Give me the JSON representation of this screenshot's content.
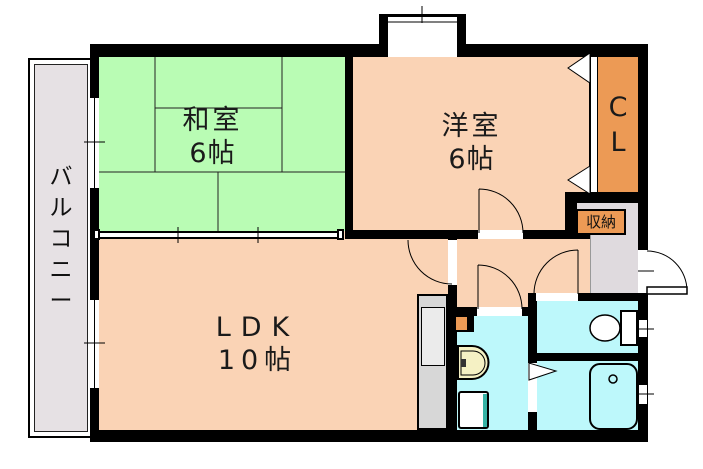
{
  "plan_title": "1LDK apartment floor plan",
  "labels": {
    "balcony": "バルコニー",
    "japanese_room": {
      "name": "和室",
      "size": "6帖"
    },
    "western_room": {
      "name": "洋室",
      "size": "6帖"
    },
    "ldk": {
      "name": "LDK",
      "size": "10帖"
    },
    "closet": "CL",
    "storage": "収納"
  },
  "colors": {
    "wall": "#000000",
    "tatami_room": "#B9FCB4",
    "rooms_floor": "#FAD3B5",
    "wet_area": "#BDF8FB",
    "closet_orange": "#EC9A55",
    "balcony_grey": "#E6E1E4",
    "entry_grey": "#DFDADE",
    "counter_grey": "#D7D7D7",
    "washbasin_cream": "#F5F1C4",
    "washer_accent": "#35B3A5"
  }
}
